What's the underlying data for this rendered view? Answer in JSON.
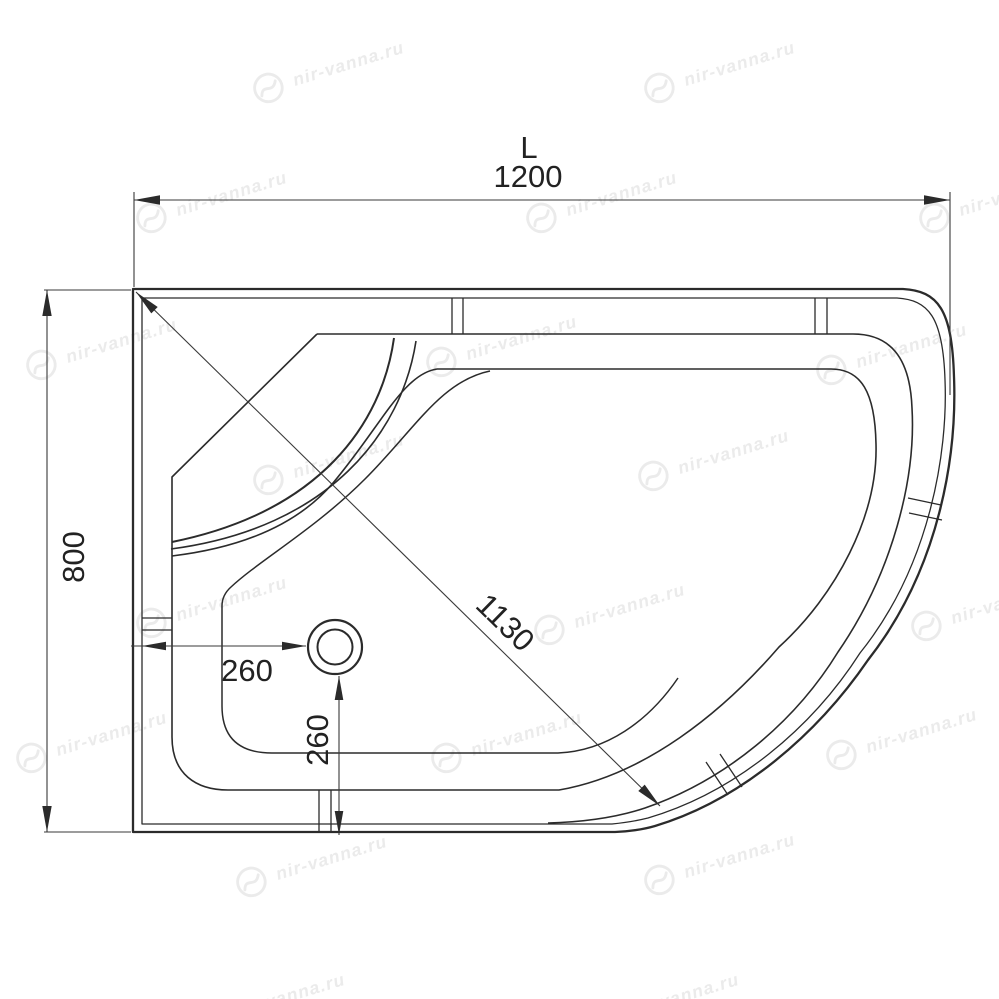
{
  "watermark": {
    "text": "nir-vanna.ru",
    "color": "#ebebeb",
    "angle_deg": -17,
    "positions": [
      [
        327,
        70
      ],
      [
        718,
        70
      ],
      [
        210,
        200
      ],
      [
        600,
        200
      ],
      [
        993,
        200
      ],
      [
        100,
        347
      ],
      [
        500,
        344
      ],
      [
        890,
        352
      ],
      [
        327,
        462
      ],
      [
        712,
        458
      ],
      [
        210,
        605
      ],
      [
        608,
        612
      ],
      [
        985,
        608
      ],
      [
        90,
        740
      ],
      [
        505,
        740
      ],
      [
        900,
        737
      ],
      [
        310,
        864
      ],
      [
        718,
        862
      ],
      [
        268,
        1002
      ],
      [
        662,
        1002
      ]
    ]
  },
  "drawing": {
    "background": "#ffffff",
    "line_color": "#2b2b2b",
    "dim_line_color": "#3a3a3a",
    "labels": {
      "length_letter": "L",
      "length": "1200",
      "depth": "800",
      "diagonal": "1130",
      "drain_offset_x": "260",
      "drain_offset_y": "260"
    }
  }
}
